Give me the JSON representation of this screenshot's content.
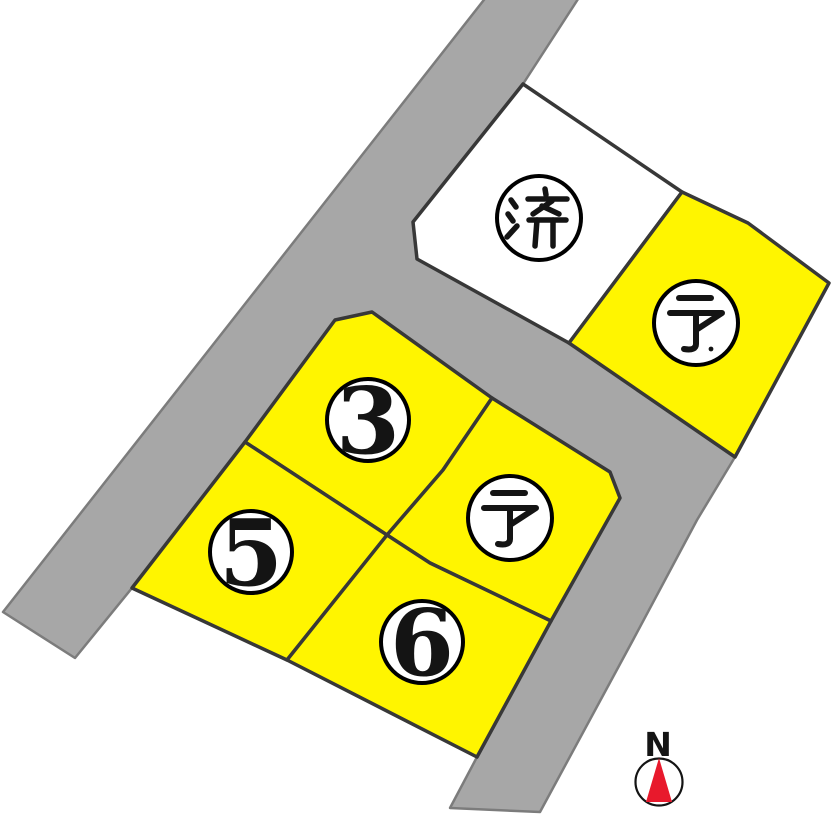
{
  "colors": {
    "road_fill": "#a7a7a7",
    "road_edge": "#7c7c7c",
    "lot_available_fill": "#fff500",
    "lot_sold_fill": "#ffffff",
    "lot_border": "#383838",
    "badge_fill": "#ffffff",
    "badge_border": "#000000",
    "ink": "#141414",
    "north_red": "#e8192c"
  },
  "lots": [
    {
      "label": "済",
      "status": "sold"
    },
    {
      "label": "予",
      "status": "reserved"
    },
    {
      "label": "3",
      "status": "available"
    },
    {
      "label": "予",
      "status": "reserved"
    },
    {
      "label": "5",
      "status": "available"
    },
    {
      "label": "6",
      "status": "available"
    }
  ],
  "compass": {
    "label": "N"
  }
}
